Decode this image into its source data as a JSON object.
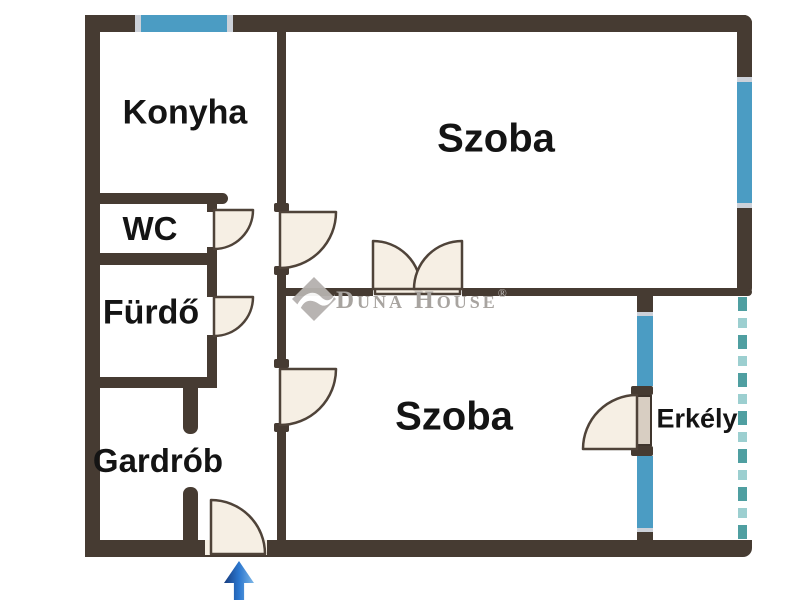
{
  "floorplan": {
    "rooms": [
      {
        "id": "konyha",
        "label": "Konyha"
      },
      {
        "id": "wc",
        "label": "WC"
      },
      {
        "id": "furdo",
        "label": "Fürdő"
      },
      {
        "id": "gardrob",
        "label": "Gardrób"
      },
      {
        "id": "szoba-felso",
        "label": "Szoba"
      },
      {
        "id": "szoba-also",
        "label": "Szoba"
      },
      {
        "id": "erkely",
        "label": "Erkély"
      }
    ],
    "watermark": {
      "brand": "Duna House",
      "registered_mark": "®"
    },
    "entrance_arrow": {
      "direction": "up"
    },
    "colors": {
      "wall": "#463b32",
      "window_glass": "#4b9cc3",
      "balcony_edge_dashed": "#4f9fa1",
      "door_fill": "#f6efe4",
      "balcony_door_leaf": "#d8cec2",
      "entrance_arrow_blue": "#2b77cf",
      "watermark_gray": "#a8a4a0",
      "label_text": "#141414"
    }
  }
}
